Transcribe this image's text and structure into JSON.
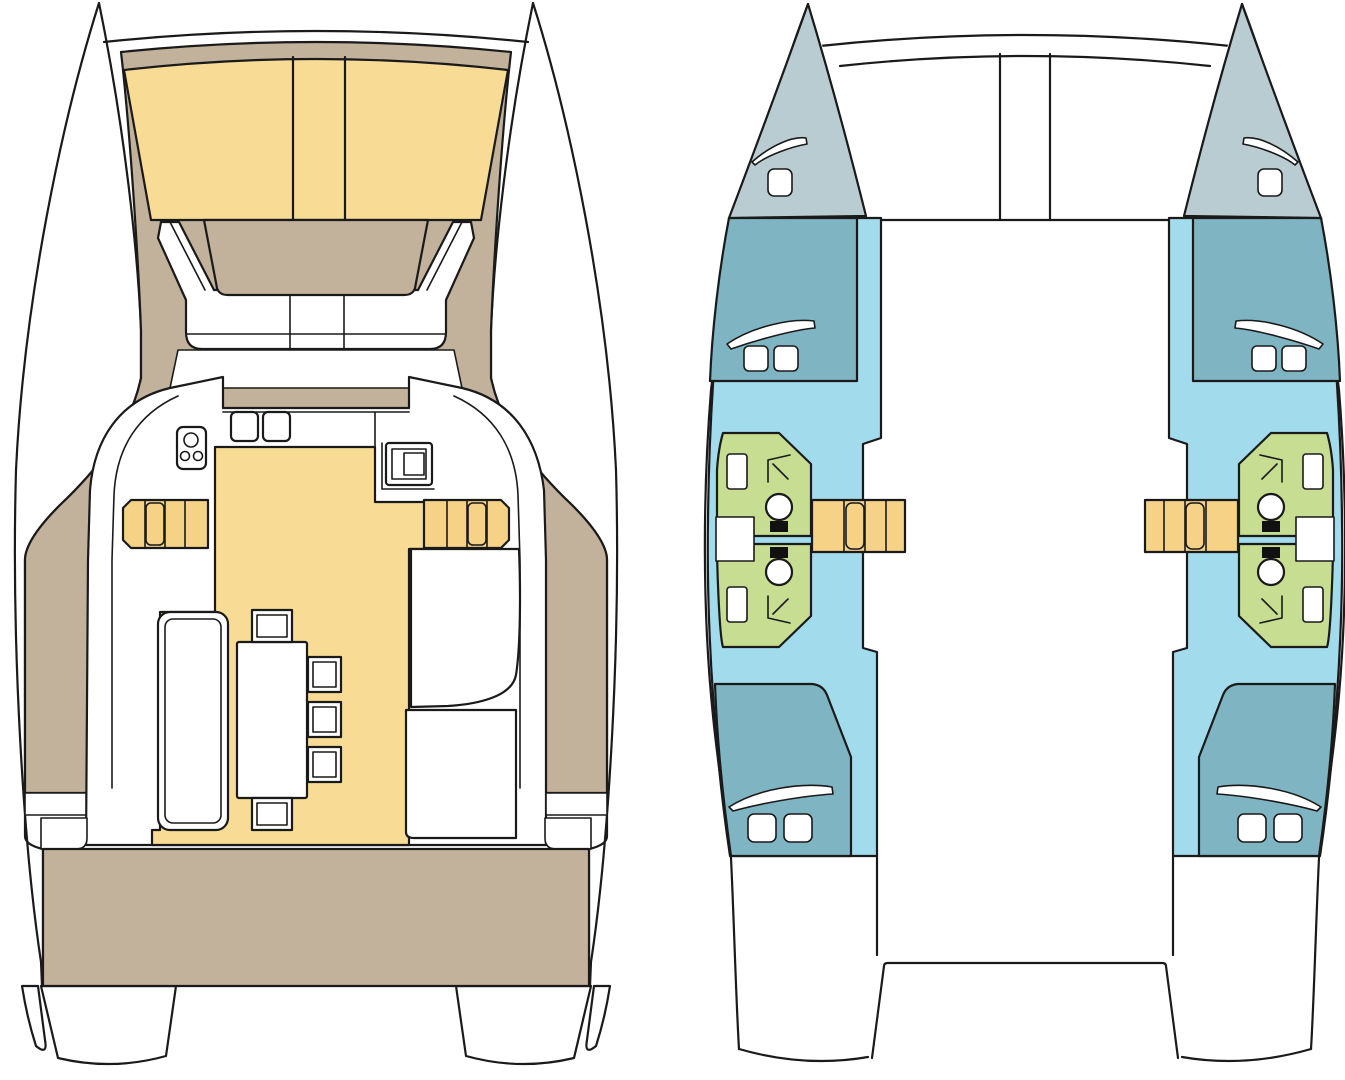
{
  "page": {
    "title": "catamaran-layout-floorplan",
    "views": 2
  },
  "colors": {
    "background": "#ffffff",
    "outline": "#1a1a1a",
    "white": "#ffffff",
    "deck_tan": "#c2b19b",
    "cushion_yellow": "#f8dc95",
    "step_yellow": "#f5d286",
    "bow_gray": "#b9ccd2",
    "cabin_teal": "#7fb5c2",
    "floor_blue": "#a2dbec",
    "bath_green": "#c6dd92",
    "toilet_black": "#111111"
  },
  "semantics": {
    "deck_plan": [
      "port-hull",
      "starboard-hull",
      "bow-crossbeam",
      "foredeck-sun-pads",
      "forward-cockpit-table",
      "forward-cockpit-bench",
      "saloon",
      "galley-stove",
      "galley-sinks",
      "galley-appliance",
      "companionway-steps",
      "dining-table",
      "dining-chairs",
      "sofa",
      "side-seats",
      "side-deck-steps",
      "aft-cockpit",
      "transoms"
    ],
    "hull_plan": [
      "bow-locker",
      "forward-cabin-berth",
      "bathroom-forward",
      "bathroom-aft",
      "shower",
      "toilet",
      "sink",
      "companionway-steps",
      "aft-cabin-berth",
      "transom-platform",
      "forward-crossbeam",
      "anchor-channel"
    ]
  }
}
